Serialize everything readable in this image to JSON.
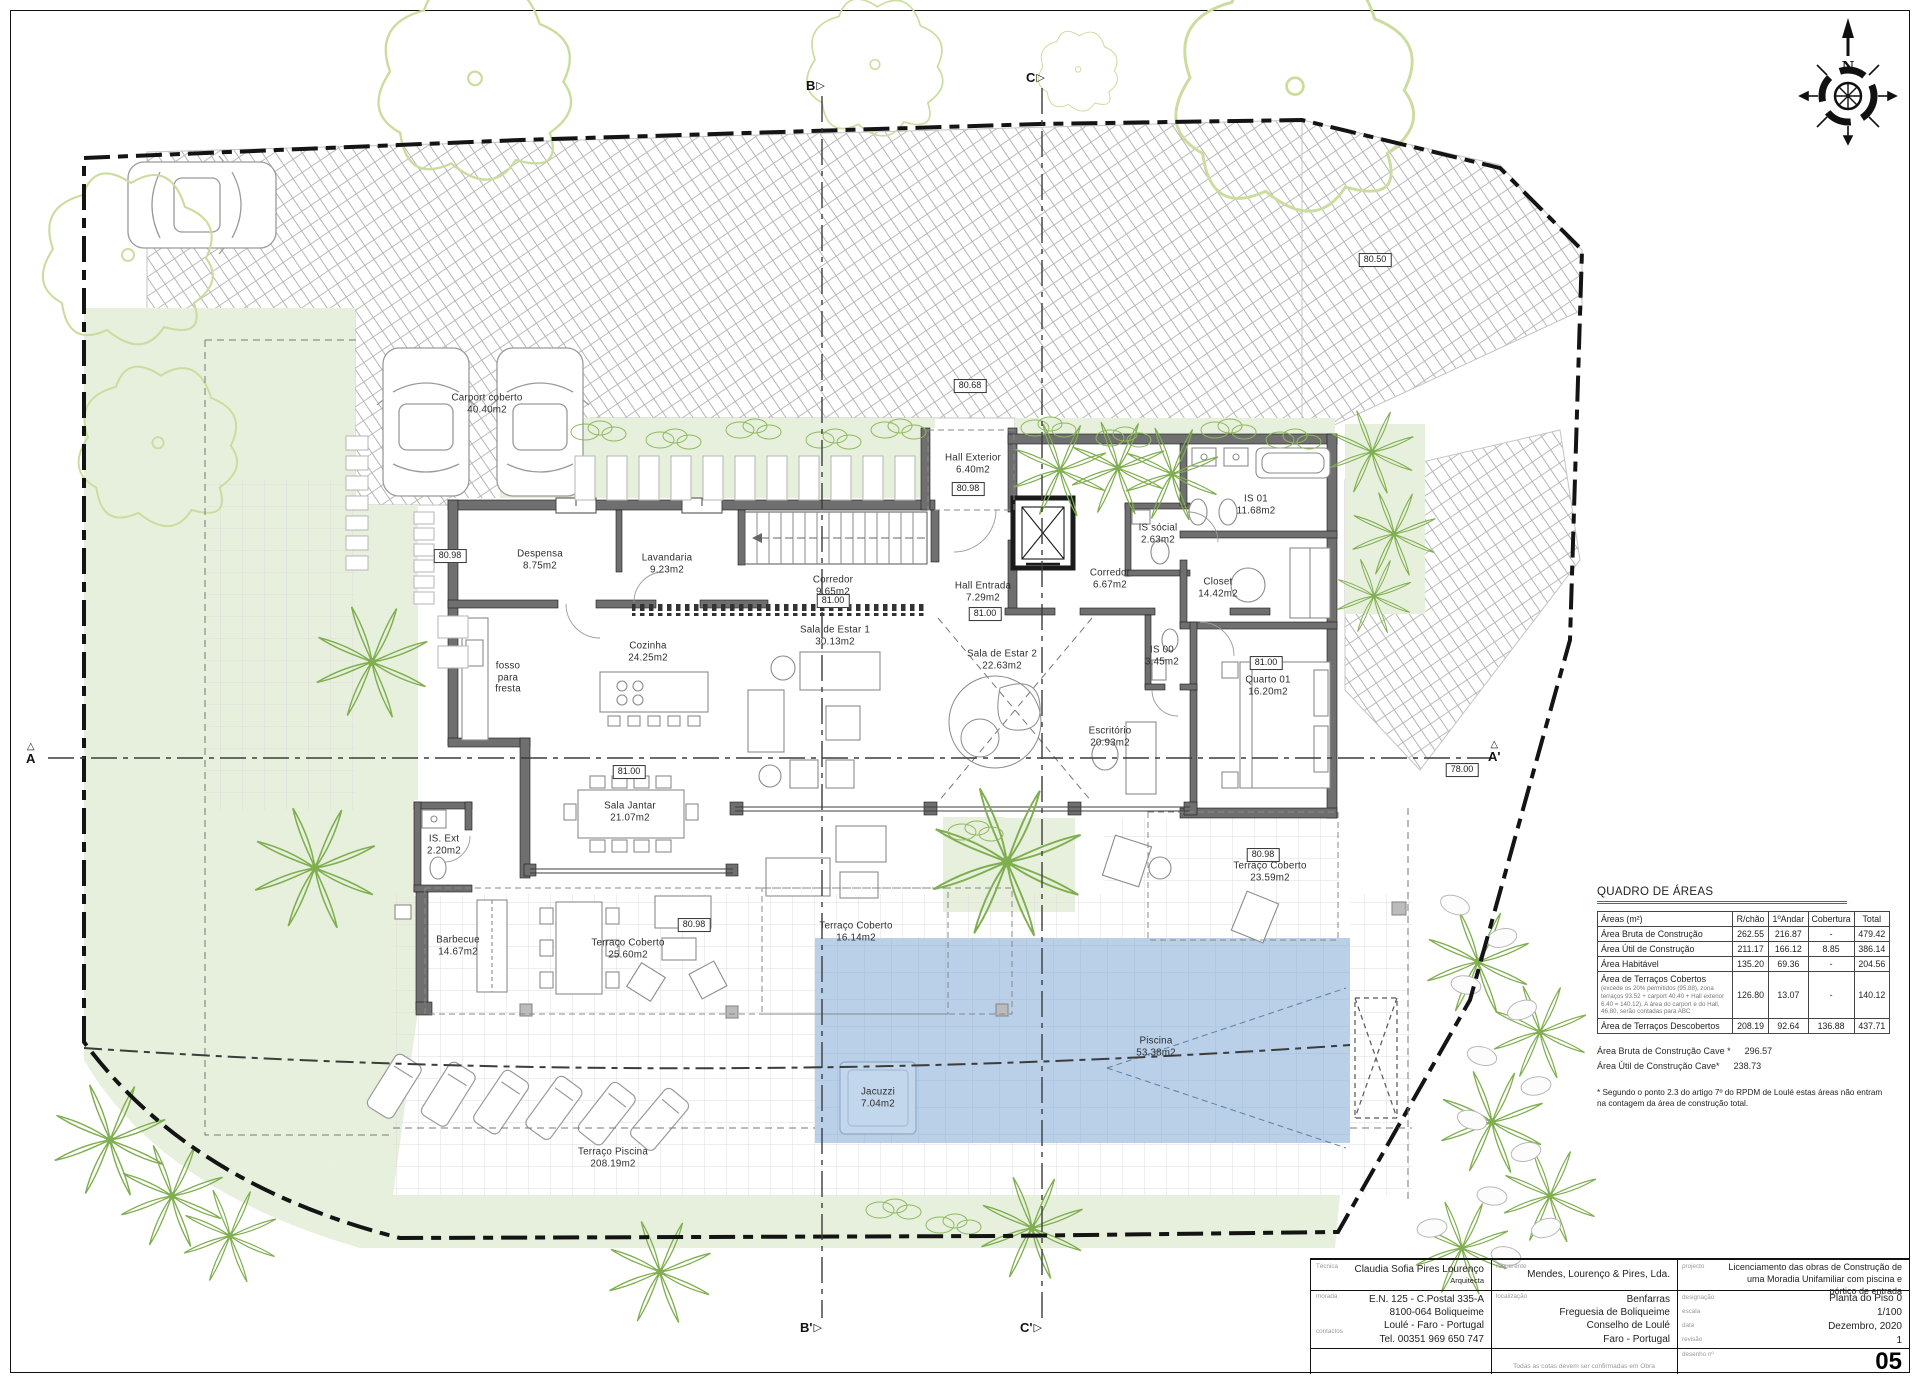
{
  "sheet": {
    "compass_label": "N"
  },
  "markers": {
    "a": "A",
    "a_prime": "A'",
    "b": "B",
    "b_prime": "B'",
    "c": "C",
    "c_prime": "C'"
  },
  "levels": [
    {
      "value": "80.98"
    },
    {
      "value": "80.68"
    },
    {
      "value": "80.98"
    },
    {
      "value": "81.00"
    },
    {
      "value": "81.00"
    },
    {
      "value": "81.00"
    },
    {
      "value": "81.00"
    },
    {
      "value": "80.98"
    },
    {
      "value": "80.98"
    },
    {
      "value": "78.00"
    },
    {
      "value": "80.50"
    }
  ],
  "rooms": [
    {
      "name": "Carport coberto",
      "area": "40.40m2"
    },
    {
      "name": "Despensa",
      "area": "8.75m2"
    },
    {
      "name": "Lavandaria",
      "area": "9.23m2"
    },
    {
      "name": "Cozinha",
      "area": "24.25m2"
    },
    {
      "name": "fosso para fresta",
      "area": ""
    },
    {
      "name": "Corredor",
      "area": "9.65m2"
    },
    {
      "name": "Hall Exterior",
      "area": "6.40m2"
    },
    {
      "name": "Hall Entrada",
      "area": "7.29m2"
    },
    {
      "name": "Corredor",
      "area": "6.67m2"
    },
    {
      "name": "IS sócial",
      "area": "2.63m2"
    },
    {
      "name": "IS 01",
      "area": "11.68m2"
    },
    {
      "name": "Closet",
      "area": "14.42m2"
    },
    {
      "name": "IS 00",
      "area": "3.45m2"
    },
    {
      "name": "Quarto 01",
      "area": "16.20m2"
    },
    {
      "name": "Sala de Estar 1",
      "area": "30.13m2"
    },
    {
      "name": "Sala de Estar 2",
      "area": "22.63m2"
    },
    {
      "name": "Escritório",
      "area": "20.93m2"
    },
    {
      "name": "Sala Jantar",
      "area": "21.07m2"
    },
    {
      "name": "IS. Ext",
      "area": "2.20m2"
    },
    {
      "name": "Barbecue",
      "area": "14.67m2"
    },
    {
      "name": "Terraço Coberto",
      "area": "25.60m2"
    },
    {
      "name": "Terraço Coberto",
      "area": "16.14m2"
    },
    {
      "name": "Terraço Coberto",
      "area": "23.59m2"
    },
    {
      "name": "Piscina",
      "area": "53.38m2"
    },
    {
      "name": "Jacuzzi",
      "area": "7.04m2"
    },
    {
      "name": "Terraço Piscina",
      "area": "208.19m2"
    }
  ],
  "areas_table": {
    "title": "QUADRO DE ÁREAS",
    "unit_header": "Áreas (m²)",
    "columns": [
      "R/chão",
      "1ºAndar",
      "Cobertura",
      "Total"
    ],
    "rows": [
      {
        "label": "Área Bruta de Construção",
        "values": [
          "262.55",
          "216.87",
          "-",
          "479.42"
        ]
      },
      {
        "label": "Área Útil de Construção",
        "values": [
          "211.17",
          "166.12",
          "8.85",
          "386.14"
        ]
      },
      {
        "label": "Área Habitável",
        "values": [
          "135.20",
          "69.36",
          "-",
          "204.56"
        ]
      },
      {
        "label": "Área de Terraços Cobertos",
        "note": "(excede os 20% permitidos (95.88), zona terraços 93.52 + carport 40.40 + Hall exterior 6.40 = 140.12). A área do carport e do Hall, 46.80, serão contadas para ABC",
        "values": [
          "126.80",
          "13.07",
          "-",
          "140.12"
        ]
      },
      {
        "label": "Área de Terraços Descobertos",
        "values": [
          "208.19",
          "92.64",
          "136.88",
          "437.71"
        ]
      }
    ],
    "extra_rows": [
      {
        "label": "Área Bruta de Construção Cave *",
        "value": "296.57"
      },
      {
        "label": "Área Útil de Construção Cave*",
        "value": "238.73"
      }
    ],
    "footnote": "* Segundo o ponto 2.3 do artigo 7º do RPDM de Loulé estas áreas não entram na contagem da área de construção total."
  },
  "title_block": {
    "technician": {
      "label": "Técnica",
      "name": "Claudia Sofia Pires Lourenço",
      "role": "Arquitecta"
    },
    "address": {
      "label": "morada",
      "line1": "E.N. 125 - C.Postal 335-A",
      "line2": "8100-064 Boliqueime",
      "line3": "Loulé - Faro - Portugal"
    },
    "contacts": {
      "label": "contactos",
      "value": "Tel. 00351 969 650 747"
    },
    "client": {
      "label": "requerente",
      "value": "Mendes, Lourenço & Pires, Lda."
    },
    "location": {
      "label": "localização",
      "line1": "Benfarras",
      "line2": "Freguesia de Boliqueime",
      "line3": "Conselho de Loulé",
      "line4": "Faro - Portugal"
    },
    "note": "Todas as cotas devem ser confirmadas em Obra",
    "project": {
      "label": "projecto",
      "value": "Licenciamento das obras de Construção de uma Moradia Unifamiliar com piscina e pórtico de entrada"
    },
    "designation": {
      "label": "designação",
      "value": "Planta do Piso 0"
    },
    "scale": {
      "label": "escala",
      "value": "1/100"
    },
    "date": {
      "label": "data",
      "value": "Dezembro, 2020"
    },
    "revision": {
      "label": "revisão",
      "value": "1"
    },
    "drawing_number": {
      "label": "desenho nº",
      "value": "05"
    }
  }
}
